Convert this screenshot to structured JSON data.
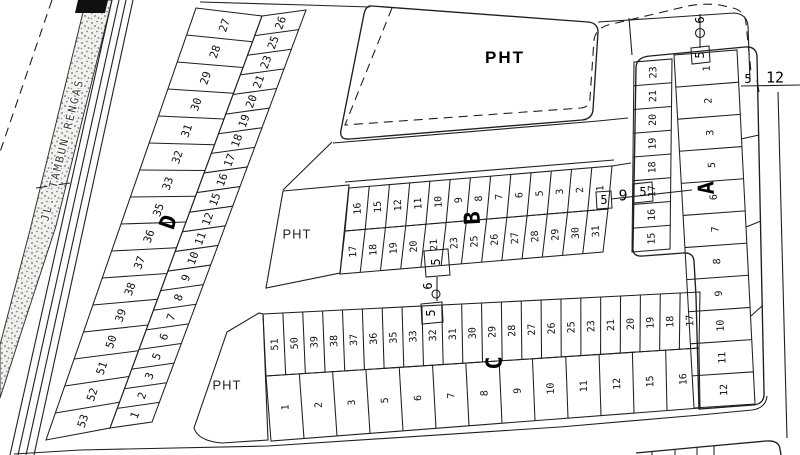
{
  "street": {
    "name": "JL. TAMBUN RENGAS"
  },
  "areas": {
    "pht_top": "PHT",
    "pht_middle": "PHT",
    "pht_bottom": "PHT"
  },
  "blocks": {
    "a": {
      "label": "A",
      "col_left": [
        "23",
        "21",
        "20",
        "19",
        "18",
        "17",
        "16",
        "15"
      ],
      "col_right": [
        "1",
        "2",
        "3",
        "5",
        "6",
        "7",
        "8",
        "9",
        "10",
        "11",
        "12"
      ]
    },
    "b": {
      "label": "B",
      "row_top": [
        "16",
        "15",
        "12",
        "11",
        "10",
        "9",
        "8",
        "7",
        "6",
        "5",
        "3",
        "2",
        "1"
      ],
      "row_bottom": [
        "17",
        "18",
        "19",
        "20",
        "21",
        "23",
        "25",
        "26",
        "27",
        "28",
        "29",
        "30",
        "31"
      ]
    },
    "c": {
      "label": "C",
      "row_top": [
        "51",
        "50",
        "39",
        "38",
        "37",
        "36",
        "35",
        "33",
        "32",
        "31",
        "30",
        "29",
        "28",
        "27",
        "26",
        "25",
        "23",
        "21",
        "20",
        "19",
        "18",
        "17"
      ],
      "row_bottom": [
        "1",
        "2",
        "3",
        "5",
        "6",
        "7",
        "8",
        "9",
        "10",
        "11",
        "12",
        "15",
        "16"
      ]
    },
    "d": {
      "label": "D",
      "col_outer": [
        "27",
        "28",
        "29",
        "30",
        "31",
        "32",
        "33",
        "35",
        "36",
        "37",
        "38",
        "39",
        "50",
        "51",
        "52",
        "53"
      ],
      "col_inner": [
        "26",
        "25",
        "23",
        "21",
        "20",
        "19",
        "18",
        "17",
        "16",
        "15",
        "12",
        "11",
        "10",
        "9",
        "8",
        "7",
        "6",
        "5",
        "3",
        "2",
        "1"
      ]
    }
  },
  "markers": {
    "b_c_crossing": {
      "top": "5",
      "middle": "6",
      "bottom": "5"
    },
    "b_a_crossing": {
      "left": "5",
      "middle": "9",
      "right": "5"
    },
    "a_top_crossing": {
      "middle": "6",
      "bottom": "5"
    },
    "a_right_crossing": {
      "left": "5",
      "right": "12"
    }
  },
  "line_color": "#1f1f1f",
  "paper_color": "#ffffff"
}
